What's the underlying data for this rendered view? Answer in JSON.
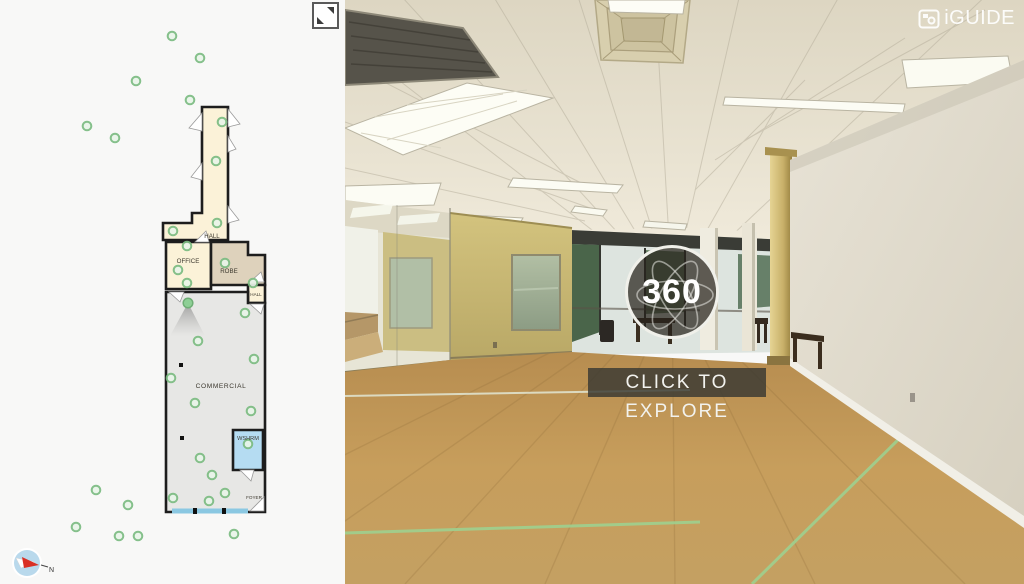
{
  "app": {
    "logo_text": "iGUIDE"
  },
  "viewer": {
    "badge_label": "360",
    "cta_label": "CLICK TO EXPLORE"
  },
  "floorplan": {
    "rooms": [
      {
        "label": "HALL"
      },
      {
        "label": "OFFICE"
      },
      {
        "label": "ROBE"
      },
      {
        "label": "HALL"
      },
      {
        "label": "COMMERCIAL"
      },
      {
        "label": "WSHRM"
      },
      {
        "label": "FOYER"
      }
    ],
    "panorama_dots": [
      [
        172,
        36
      ],
      [
        200,
        58
      ],
      [
        136,
        81
      ],
      [
        190,
        100
      ],
      [
        87,
        126
      ],
      [
        115,
        138
      ],
      [
        222,
        122
      ],
      [
        216,
        161
      ],
      [
        217,
        223
      ],
      [
        173,
        231
      ],
      [
        187,
        246
      ],
      [
        178,
        270
      ],
      [
        187,
        283
      ],
      [
        225,
        263
      ],
      [
        253,
        283
      ],
      [
        245,
        313
      ],
      [
        198,
        341
      ],
      [
        254,
        359
      ],
      [
        171,
        378
      ],
      [
        195,
        403
      ],
      [
        251,
        411
      ],
      [
        200,
        458
      ],
      [
        212,
        475
      ],
      [
        225,
        493
      ],
      [
        173,
        498
      ],
      [
        209,
        501
      ],
      [
        248,
        444
      ],
      [
        96,
        490
      ],
      [
        128,
        505
      ],
      [
        76,
        527
      ],
      [
        119,
        536
      ],
      [
        138,
        536
      ],
      [
        234,
        534
      ]
    ],
    "active_dot": [
      188,
      303
    ],
    "post_markers": [
      [
        181,
        365
      ],
      [
        182,
        438
      ]
    ],
    "compass": {
      "north_label": "N"
    }
  },
  "colors": {
    "room_cream": "#fbf2d8",
    "room_tan": "#ded2bc",
    "room_gray": "#e7e7e5",
    "room_blue": "#b5dcf2",
    "wall": "#1d1d1d",
    "dot_ring": "#7cbc82",
    "dot_fill": "#e9f5e9",
    "active_dot": "#8ecf95",
    "window_blue": "#8bc8e2",
    "cta_bg": "rgba(56,56,50,0.82)"
  }
}
